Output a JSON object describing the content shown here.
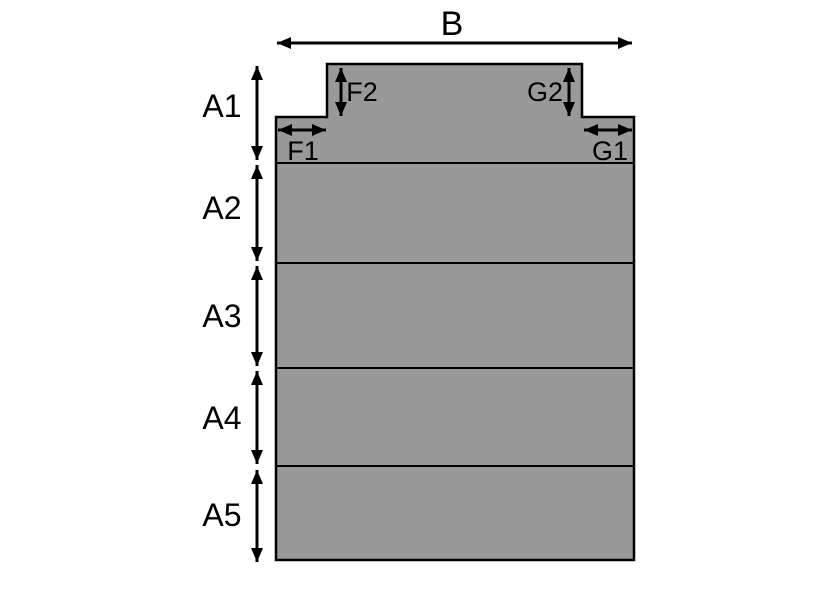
{
  "diagram": {
    "overall_width_label": "B",
    "section_height_labels": [
      "A1",
      "A2",
      "A3",
      "A4",
      "A5"
    ],
    "shoulder_width_labels": {
      "left": "F1",
      "right": "G1"
    },
    "neck_height_labels": {
      "left": "F2",
      "right": "G2"
    },
    "colors": {
      "shape_fill": "#999999",
      "line": "#000000",
      "background": "#ffffff"
    }
  }
}
